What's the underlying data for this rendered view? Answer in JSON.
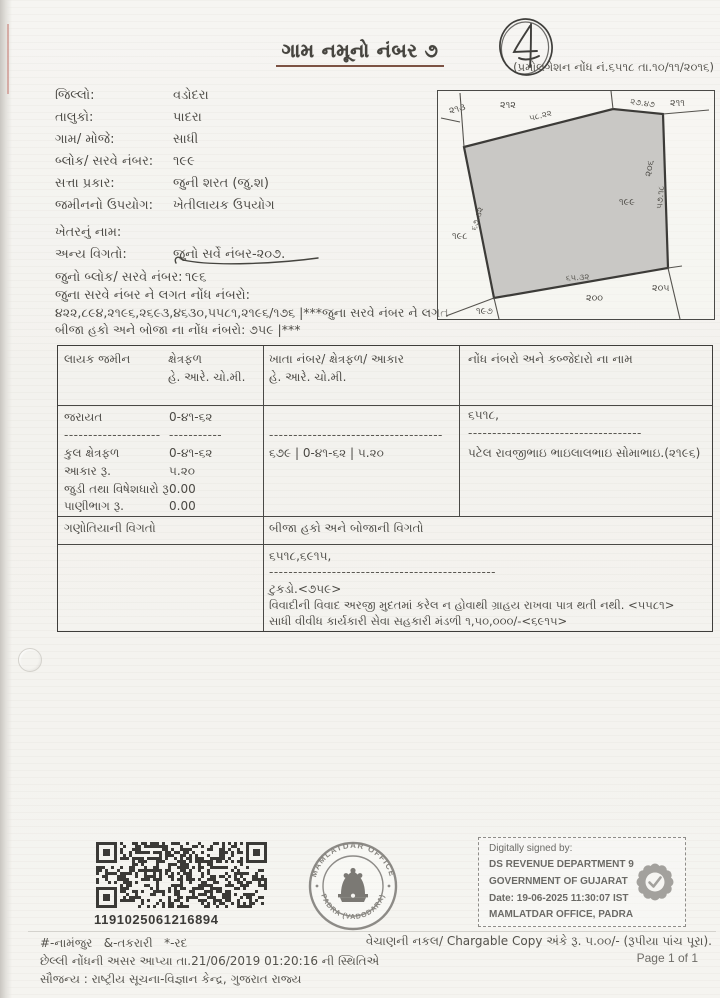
{
  "page": {
    "title": "ગામ નમૂનો નંબર ૭",
    "promulgation_note": "(પ્રમોલગેશન નોંધ નં.૬૫૧૮ તા.૧૦/૧૧/૨૦૧૬)",
    "handwritten_mark": "4"
  },
  "fields": [
    {
      "label": "જિલ્લો:",
      "value": "વડોદરા"
    },
    {
      "label": "તાલુકો:",
      "value": "પાદરા"
    },
    {
      "label": "ગામ/ મોજે:",
      "value": "સાધી"
    },
    {
      "label": "બ્લોક/ સરવે નંબર:",
      "value": "૧૯૯"
    },
    {
      "label": "સત્તા પ્રકાર:",
      "value": "જુની શરત (જુ.શ)"
    },
    {
      "label": "જમીનનો ઉપયોગ:",
      "value": "ખેતીલાયક ઉપયોગ"
    },
    {
      "label": "ખેતરનું નામ:",
      "value": ""
    },
    {
      "label": "અન્ય વિગતો:",
      "value": "જુનો સર્વે નંબર-૨૦૭."
    },
    {
      "label": "જુનો બ્લોક/ સરવે નંબર:",
      "value": "૧૯૬"
    }
  ],
  "old_notes": {
    "label": "જુના સરવે નંબર ને લગત નોંધ નંબરો:",
    "line1": "૪૨૨,૮૯૪,૨૧૯૬,૨૬૯૩,૪૬૩૦,૫૫૮૧,૨૧૯૬/૧૭૬ |***જુના સરવે નંબર ને લગત",
    "line2": "બીજા હકો અને બોજા ના નોંધ નંબરો: ૭૫૯ |***"
  },
  "map": {
    "center": "૧૯૯",
    "n_top_left": "૨૧૩",
    "n_top": "૨૧૨",
    "n_top_right": "૨૧૧",
    "n_right": "૨૦૬",
    "n_bottom_right": "૨૦૫",
    "n_bottom": "૨૦૦",
    "n_bottom_left": "૧૯૭",
    "n_left": "૧૯૮",
    "m_top": "૫૮.૨૨",
    "m_top_right": "૨૭.૪૭",
    "m_right": "૫૭.૧૮",
    "m_bottom": "૬૫.૩૨",
    "m_left": "૬૭.૩૨"
  },
  "table": {
    "headers": {
      "eligible_land": "લાયક જમીન",
      "area": "ક્ષેત્રફળ",
      "area_unit": "હે. આરે. ચો.મી.",
      "account": "ખાતા નંબર/ ક્ષેત્રફળ/ આકાર",
      "account_unit": "હે. આરે. ચો.મી.",
      "notes_names": "નોંધ નંબરો અને કબ્જેદારો ના નામ"
    },
    "land_rows": [
      {
        "label": "જરાયત",
        "value": "0-૪૧-૬૨"
      },
      {
        "label": "--------------------",
        "value": "-----------"
      },
      {
        "label": "કુલ ક્ષેત્રફળ",
        "value": "0-૪૧-૬૨"
      },
      {
        "label": "આકાર રૂ.",
        "value": "૫.૨૦"
      },
      {
        "label": "જુડી તથા વિષેશધારો રૂ",
        "value": "0.00"
      },
      {
        "label": "પાણીભાગ રૂ.",
        "value": "0.00"
      }
    ],
    "account_cell": {
      "dashes": "------------------------------------",
      "value": "૬૭૯ | 0-૪૧-૬૨ | ૫.૨૦"
    },
    "notes_cell": {
      "note": "૬૫૧૮,",
      "dashes": "------------------------------------",
      "name": "પટેલ રાવજીભાઇ ભાઇલાલભાઇ સોમાભાઇ.(૨૧૯૬)"
    },
    "tenant_header": "ગણોતિયાની વિગતો",
    "other_rights_header": "બીજા હકો અને બોજાની વિગતો",
    "other_rights": {
      "line1": "૬૫૧૮,૬૯૧૫,",
      "dashes": "-----------------------------------------------",
      "line2": "ટુકડો.<૭૫૯>",
      "line3": "વિવાદીની વિવાદ અરજી મુદતમાં કરેલ ન હોવાથી ગ્રાહય રાખવા પાત્ર થતી નથી. <૫૫૮૧>",
      "line4": "સાધી વીવીધ કાર્યકારી સેવા સહકારી મંડળી ૧,૫૦,૦૦૦/-<૬૯૧૫>"
    }
  },
  "qr": {
    "number": "1191025061216894"
  },
  "stamp": {
    "arc_top": "MAMLATDAR OFFICE",
    "arc_bottom": "PADRA (VADODARA)"
  },
  "signature": {
    "line1": "Digitally signed by:",
    "line2": "DS REVENUE DEPARTMENT 9",
    "line3": "GOVERNMENT OF GUJARAT",
    "line4": "Date: 19-06-2025 11:30:07 IST",
    "line5": "MAMLATDAR OFFICE, PADRA"
  },
  "footer": {
    "legend": "#-નામંજુર   &-તકરારી   *-રદ",
    "last_note": "છેલ્લી નોંધની અસર આપ્યા તા.21/06/2019 01:20:16 ની સ્થિતિએ",
    "courtesy": "સૌજન્ય : રાષ્ટ્રીય સૂચના-વિજ્ઞાન કેન્દ્ર, ગુજરાત રાજ્ય",
    "chargeable": "વેચાણની નકલ/ Chargable Copy અંકે રૂ. ૫.૦૦/- (રૂપીયા પાંચ પૂરા).",
    "page_no": "Page 1 of 1"
  }
}
